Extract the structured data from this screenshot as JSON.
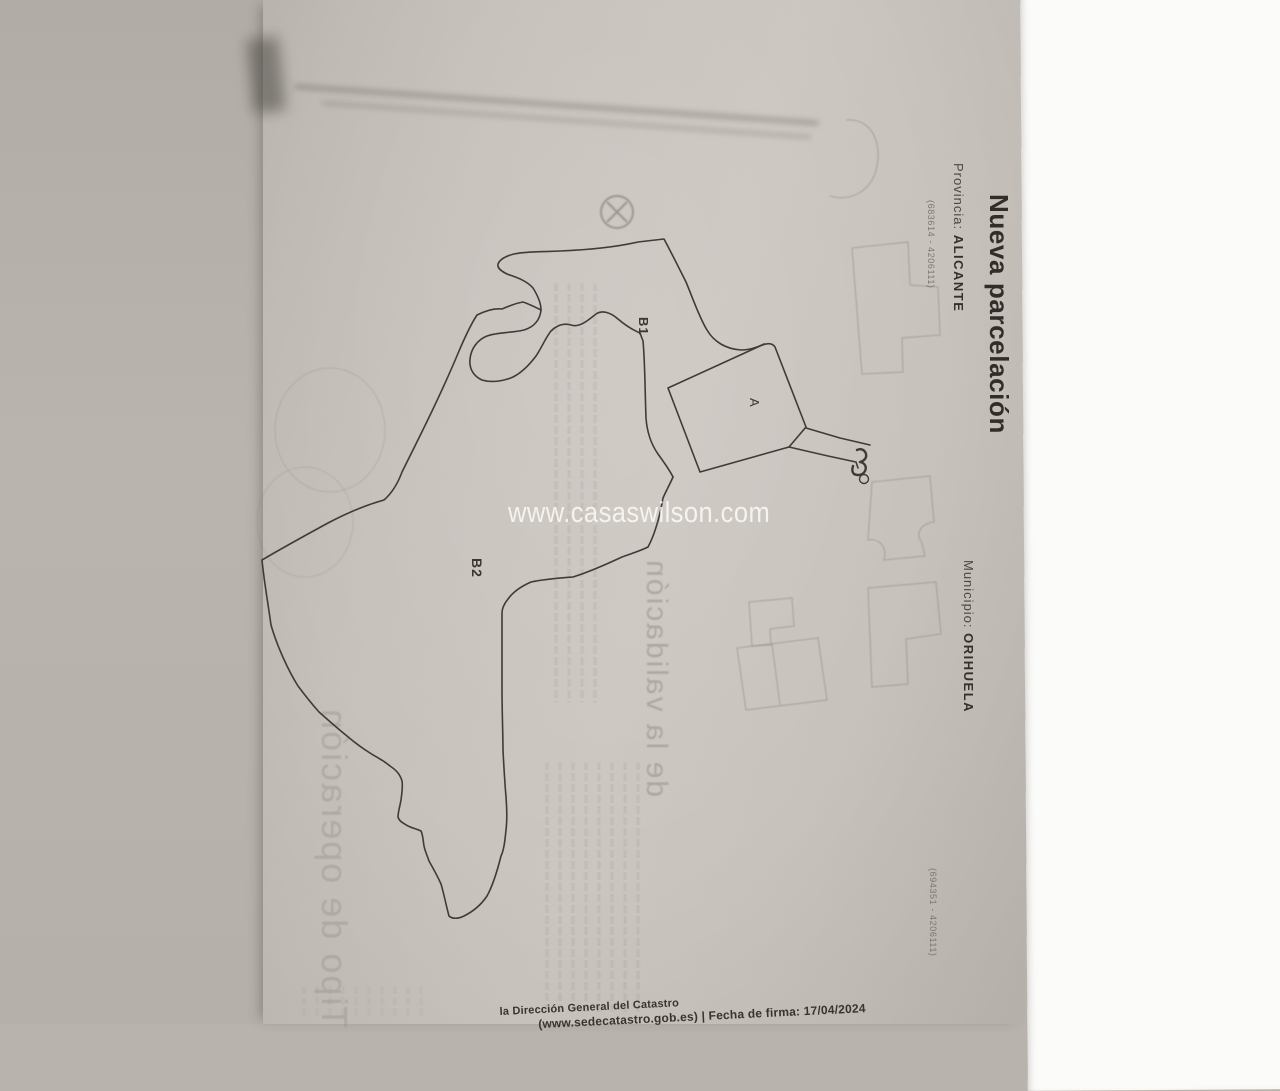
{
  "document": {
    "title": "Nueva parcelación",
    "provincia": {
      "label": "Provincia:",
      "value": "ALICANTE"
    },
    "municipio": {
      "label": "Municipio:",
      "value": "ORIHUELA"
    },
    "corner_coords_top": "(683614 - 4206111)",
    "corner_coords_bottom": "(694351 - 4206111)",
    "parcel_labels": {
      "b1": "B1",
      "b2": "B2",
      "a": "A"
    },
    "watermark": "www.casaswilson.com",
    "footer": {
      "line1": "la Dirección General del Catastro",
      "line2": "(www.sedecatastro.gob.es)  |  Fecha de firma: 17/04/2024"
    },
    "showthrough_text": {
      "heading_validacion": "de la validación",
      "heading_tipo": "Tipo de operación"
    },
    "colors": {
      "paper": "#c7c1bb",
      "ink": "#3f3b37",
      "watermark": "#fcfcfa",
      "showthrough": "#928c86",
      "background_left": "#b7b1ab",
      "background_right": "#fbfbf9"
    }
  }
}
